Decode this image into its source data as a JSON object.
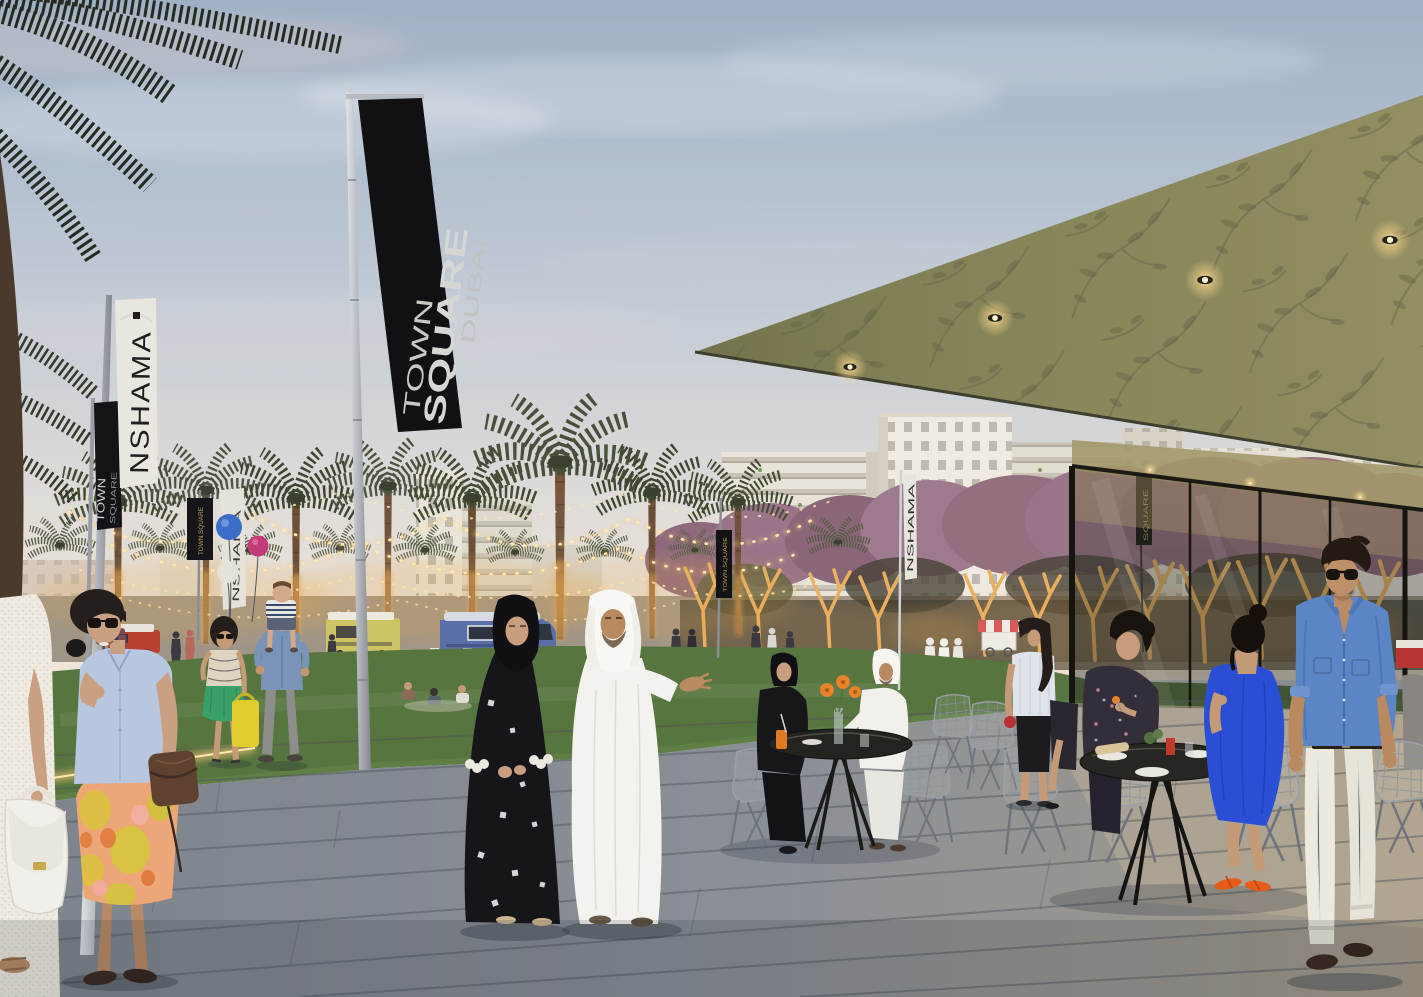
{
  "scene": {
    "banners": {
      "main": {
        "line1": "TOWN",
        "line2": "SQUARE",
        "line3": "DUBAI"
      },
      "nshama_white": "NSHAMA",
      "town_black_col1": "TOWN",
      "town_black_col2": "SQUARE",
      "small_white": "NSHAMA",
      "small_black": "TOWN SQUARE",
      "distant_white": "NSHAMA",
      "glass_black": "SQUARE"
    },
    "palette": {
      "sky_top": "#9fb0c6",
      "sky_horizon": "#efe6d8",
      "roof": "#8a8a5c",
      "lawn": "#5f7f45",
      "paving": "#828890",
      "banner_black": "#141418",
      "banner_white": "#e9e6df",
      "balloon_blue": "#3a6cc8",
      "balloon_magenta": "#c23a78",
      "balloon_cream": "#e4e2d6",
      "truck_blue": "#5a6fa8",
      "truck_red": "#b8402e",
      "truck_yellow": "#cfc464",
      "dress_blue": "#2b4fd4",
      "shirt_denim": "#5b85c4",
      "skirt_floral": "#eda678",
      "kandura_white": "#f4f2ee",
      "abaya_black": "#15151a",
      "string_light": "#ffdf9e"
    }
  }
}
